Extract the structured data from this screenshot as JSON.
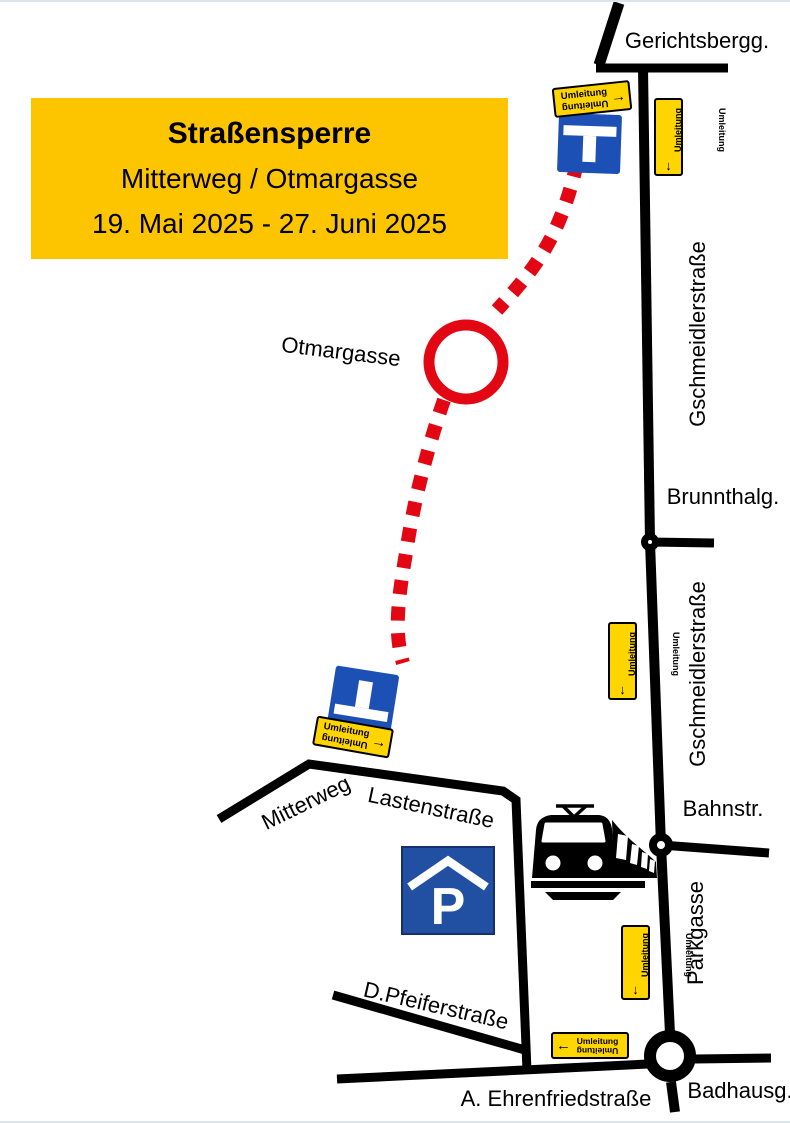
{
  "title_box": {
    "line1": "Straßensperre",
    "line2": "Mitterweg / Otmargasse",
    "line3": "19. Mai 2025 - 27. Juni 2025"
  },
  "streets": {
    "gerichtsbergg": "Gerichtsbergg.",
    "gschmeidlerstrasse": "Gschmeidlerstraße",
    "brunnthalg": "Brunnthalg.",
    "bahnstr": "Bahnstr.",
    "parkgasse": "Parkgasse",
    "badhausg": "Badhausg.",
    "otmargasse": "Otmargasse",
    "mitterweg": "Mitterweg",
    "lastenstrasse": "Lastenstraße",
    "dpfeiferstrasse": "D.Pfeiferstraße",
    "ehrenfriedstrasse": "A. Ehrenfriedstraße"
  },
  "detour_sign": {
    "label": "Umleitung",
    "arrow_right": "→",
    "arrow_left": "←",
    "arrow_down": "↓"
  },
  "parking_sign": {
    "label": "P"
  },
  "colors": {
    "closure_red": "#e30613",
    "sign_yellow": "#ffd500",
    "title_yellow": "#fcc500",
    "dead_end_blue": "#1d50b4",
    "parking_blue": "#2150a3",
    "road_black": "#000000"
  }
}
